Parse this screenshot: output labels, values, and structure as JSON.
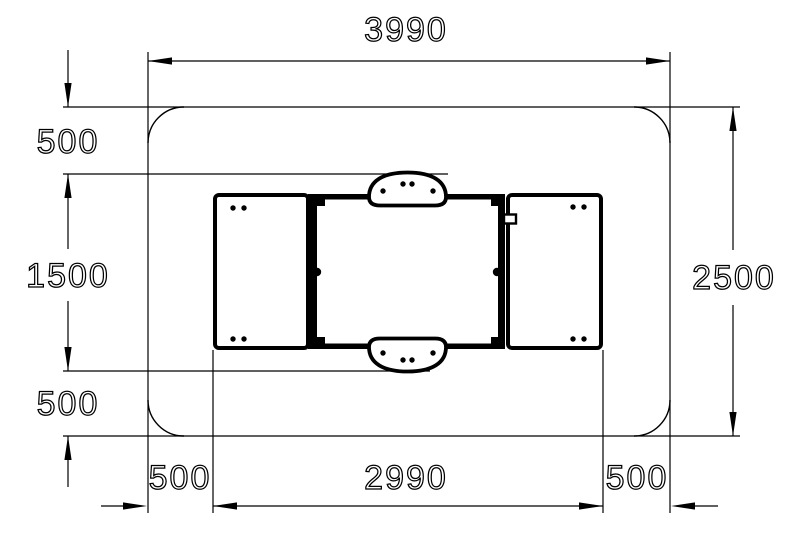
{
  "drawing": {
    "kind": "equipment-plan-view-dimension-drawing",
    "colors": {
      "line": "#000000",
      "background": "#ffffff",
      "text": "#000000"
    }
  },
  "dims": {
    "zone_width": "3990",
    "zone_height": "2500",
    "top_clearance": "500",
    "item_depth": "1500",
    "bottom_clearance": "500",
    "left_clearance": "500",
    "item_width": "2990",
    "right_clearance": "500"
  }
}
